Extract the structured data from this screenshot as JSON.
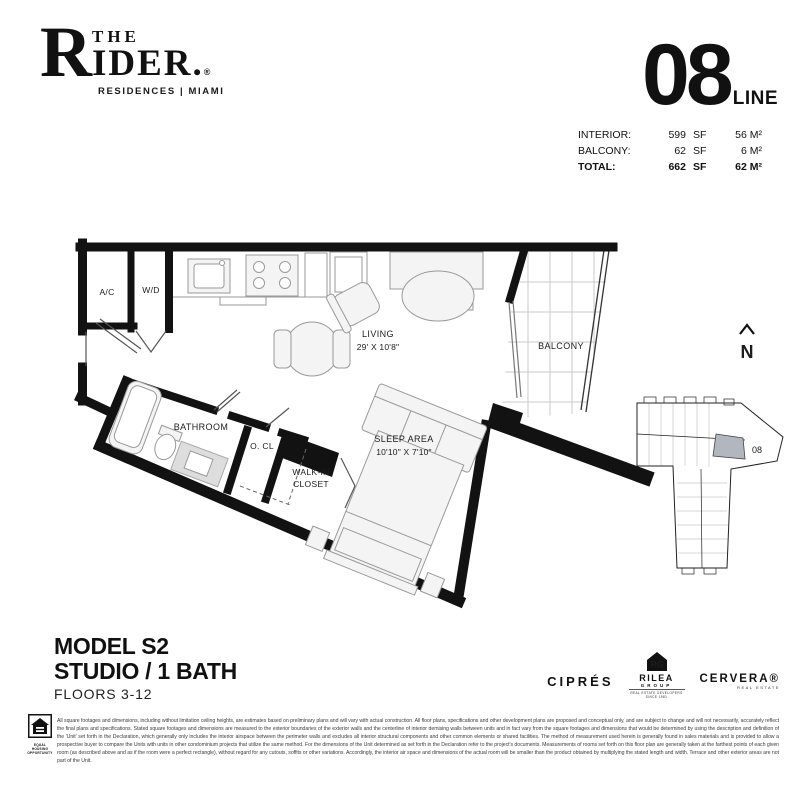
{
  "brand": {
    "initial": "R",
    "top": "THE",
    "rest": "IDER.",
    "reg": "®",
    "tagline": "RESIDENCES | MIAMI"
  },
  "unit_stats": {
    "line_number": "08",
    "line_label": "LINE",
    "rows": [
      {
        "label": "INTERIOR:",
        "sf": "599",
        "sf_unit": "SF",
        "metric": "56 M²"
      },
      {
        "label": "BALCONY:",
        "sf": "62",
        "sf_unit": "SF",
        "metric": "6 M²"
      },
      {
        "label": "TOTAL:",
        "sf": "662",
        "sf_unit": "SF",
        "metric": "62 M²"
      }
    ]
  },
  "floorplan": {
    "labels": {
      "ac": "A/C",
      "wd": "W/D",
      "living": "LIVING",
      "living_dims": "29' X 10'8\"",
      "sleep_area": "SLEEP AREA",
      "sleep_dims": "10'10\" X 7'10\"",
      "bathroom": "BATHROOM",
      "ocl": "O. CL",
      "walkin_1": "WALK-IN",
      "walkin_2": "CLOSET",
      "balcony": "BALCONY"
    }
  },
  "compass": {
    "label": "N"
  },
  "keyplan": {
    "unit_label": "08"
  },
  "model_info": {
    "model": "MODEL S2",
    "type": "STUDIO / 1 BATH",
    "floors": "FLOORS 3-12"
  },
  "developers": {
    "cipres": "CIPRÉS",
    "rilea_initials": "RG",
    "rilea_name": "RILEA",
    "rilea_group": "GROUP",
    "rilea_tagline": "REAL ESTATE DEVELOPERS SINCE 1981",
    "cervera": "CERVERA®",
    "cervera_tagline": "REAL ESTATE"
  },
  "legal": {
    "equal_housing": "EQUAL HOUSING OPPORTUNITY",
    "disclaimer_lines": [
      "All square footages and dimensions, including without limitation ceiling heights, are estimates based on preliminary plans and will vary with actual construction. All floor plans, specifications and other development plans are proposed and conceptual only, and are subject to change and will not necessarily, accurately reflect the final plans and specifications. Stated square footages and dimensions are measured to",
      "the exterior boundaries of the exterior walls and the centerline of interior demising walls between units and in fact vary from the square footages and dimensions that would be determined by using the description and definition of the 'Unit' set forth in the Declaration, which generally only includes the interior airspace between the perimeter walls and excludes all interior structural components and other",
      "common elements or shared facilities. The method of measurement used herein is generally found in sales materials and is provided to allow a prospective buyer to compare the Units with units in other condominium projects that utilize the same method. For the dimensions of the Unit determined as set forth in the Declaration refer to the project's documents. Measurements of rooms set forth on",
      "this floor plan are generally taken at the farthest points of each given room (as described above and as if the room were a perfect rectangle), without regard for any cutouts, soffits or other variations. Accordingly, the interior air space and dimensions of the actual room will be smaller than the product obtained by multiplying the stated length and width. Terrace and other exterior areas are not part of the Unit."
    ]
  },
  "colors": {
    "wall": "#121212",
    "furniture_fill": "#f4f4f4",
    "furniture_stroke": "#9a9a9a",
    "balcony_grid": "#c9c9c9",
    "keyplan_unit_fill": "#b2b6be"
  }
}
